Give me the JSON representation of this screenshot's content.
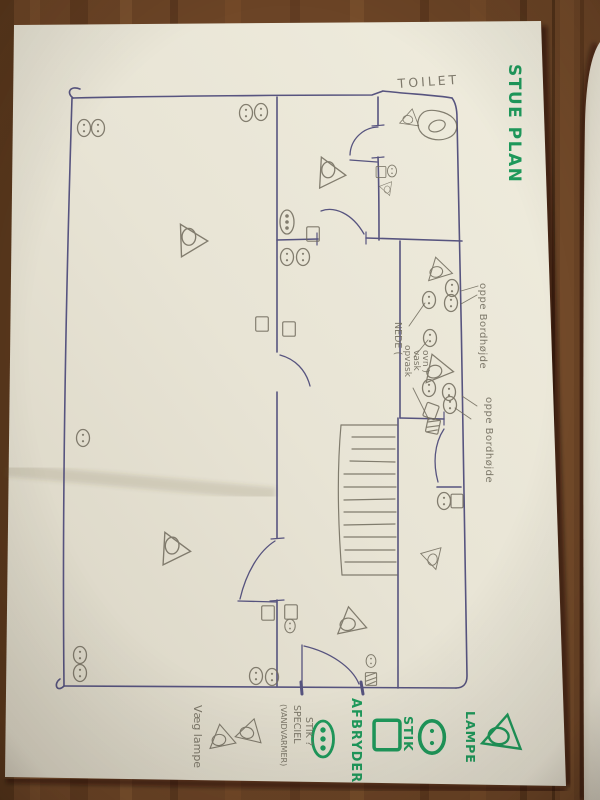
{
  "title": "STUE PLAN",
  "room_labels": {
    "toilet": "TOILET"
  },
  "annotations": {
    "counter_note_top": "oppe Bordhøjde",
    "counter_note_bottom": "oppe Bordhøjde",
    "nede_note_line1": "NEDE (",
    "nede_note_line2": "opvask",
    "nede_note_line3": "vask",
    "nede_note_line4": "ovn )",
    "wall_lamp_note": "Væg lampe",
    "special_note_line1": "SPECIEL",
    "special_note_line2": "STIK ?",
    "special_note_line3": "(VANDVARMER)"
  },
  "legend": {
    "lamp_label": "LAMPE",
    "socket_label": "STIK",
    "switch_label": "AFBRYDER"
  },
  "colors": {
    "marker_green": "#1f9a5c",
    "pen_blue": "#4b4878",
    "pencil_gray": "#6f6a5c",
    "paper": "#eae5d7",
    "wood": "#6b4426"
  },
  "symbols": [
    {
      "t": "lamp",
      "x": 192,
      "y": 240,
      "r": 90,
      "s": 1.05
    },
    {
      "t": "lamp",
      "x": 175,
      "y": 549,
      "r": 95,
      "s": 1.05
    },
    {
      "t": "lamp",
      "x": 331,
      "y": 173,
      "r": 95,
      "s": 1
    },
    {
      "t": "lamp",
      "x": 410,
      "y": 118,
      "r": 10,
      "s": 0.62
    },
    {
      "t": "lamp",
      "x": 386,
      "y": 188,
      "r": -80,
      "s": 0.45
    },
    {
      "t": "lamp",
      "x": 438,
      "y": 269,
      "r": -15,
      "s": 0.8
    },
    {
      "t": "lamp",
      "x": 436,
      "y": 368,
      "r": -20,
      "s": 0.95
    },
    {
      "t": "lamp",
      "x": 431,
      "y": 557,
      "r": -75,
      "s": 0.72
    },
    {
      "t": "lamp",
      "x": 350,
      "y": 621,
      "r": -10,
      "s": 0.95
    },
    {
      "t": "socket",
      "x": 84,
      "y": 128
    },
    {
      "t": "socket",
      "x": 98,
      "y": 128
    },
    {
      "t": "socket",
      "x": 246,
      "y": 113
    },
    {
      "t": "socket",
      "x": 261,
      "y": 112
    },
    {
      "t": "socket",
      "x": 83,
      "y": 438
    },
    {
      "t": "socket",
      "x": 80,
      "y": 655
    },
    {
      "t": "socket",
      "x": 80,
      "y": 673
    },
    {
      "t": "socket",
      "x": 256,
      "y": 676
    },
    {
      "t": "socket",
      "x": 272,
      "y": 677
    },
    {
      "t": "socket",
      "x": 287,
      "y": 257
    },
    {
      "t": "socket",
      "x": 303,
      "y": 257
    },
    {
      "t": "socket",
      "x": 392,
      "y": 171,
      "s": 0.7
    },
    {
      "t": "socket",
      "x": 452,
      "y": 288
    },
    {
      "t": "socket",
      "x": 451,
      "y": 303
    },
    {
      "t": "socket",
      "x": 429,
      "y": 300
    },
    {
      "t": "socket",
      "x": 430,
      "y": 338
    },
    {
      "t": "socket",
      "x": 429,
      "y": 388
    },
    {
      "t": "socket",
      "x": 449,
      "y": 392
    },
    {
      "t": "socket",
      "x": 450,
      "y": 405
    },
    {
      "t": "socket",
      "x": 444,
      "y": 501
    },
    {
      "t": "socket",
      "x": 290,
      "y": 626,
      "s": 0.8
    },
    {
      "t": "socket",
      "x": 371,
      "y": 661,
      "s": 0.75
    },
    {
      "t": "switch",
      "x": 313,
      "y": 234,
      "s": 0.9
    },
    {
      "t": "switch",
      "x": 262,
      "y": 324,
      "s": 0.9
    },
    {
      "t": "switch",
      "x": 289,
      "y": 329,
      "s": 0.9
    },
    {
      "t": "switch",
      "x": 381,
      "y": 172,
      "s": 0.7
    },
    {
      "t": "switch",
      "x": 431,
      "y": 411,
      "r": 20,
      "s": 0.9
    },
    {
      "t": "switch",
      "x": 457,
      "y": 501,
      "s": 0.85
    },
    {
      "t": "switch",
      "x": 268,
      "y": 613,
      "s": 0.9
    },
    {
      "t": "switch",
      "x": 291,
      "y": 612,
      "s": 0.9
    },
    {
      "t": "switch_x",
      "x": 433,
      "y": 426,
      "r": 12,
      "s": 0.9
    },
    {
      "t": "switch_x",
      "x": 371,
      "y": 679,
      "s": 0.8
    },
    {
      "t": "special",
      "x": 287,
      "y": 222
    }
  ]
}
